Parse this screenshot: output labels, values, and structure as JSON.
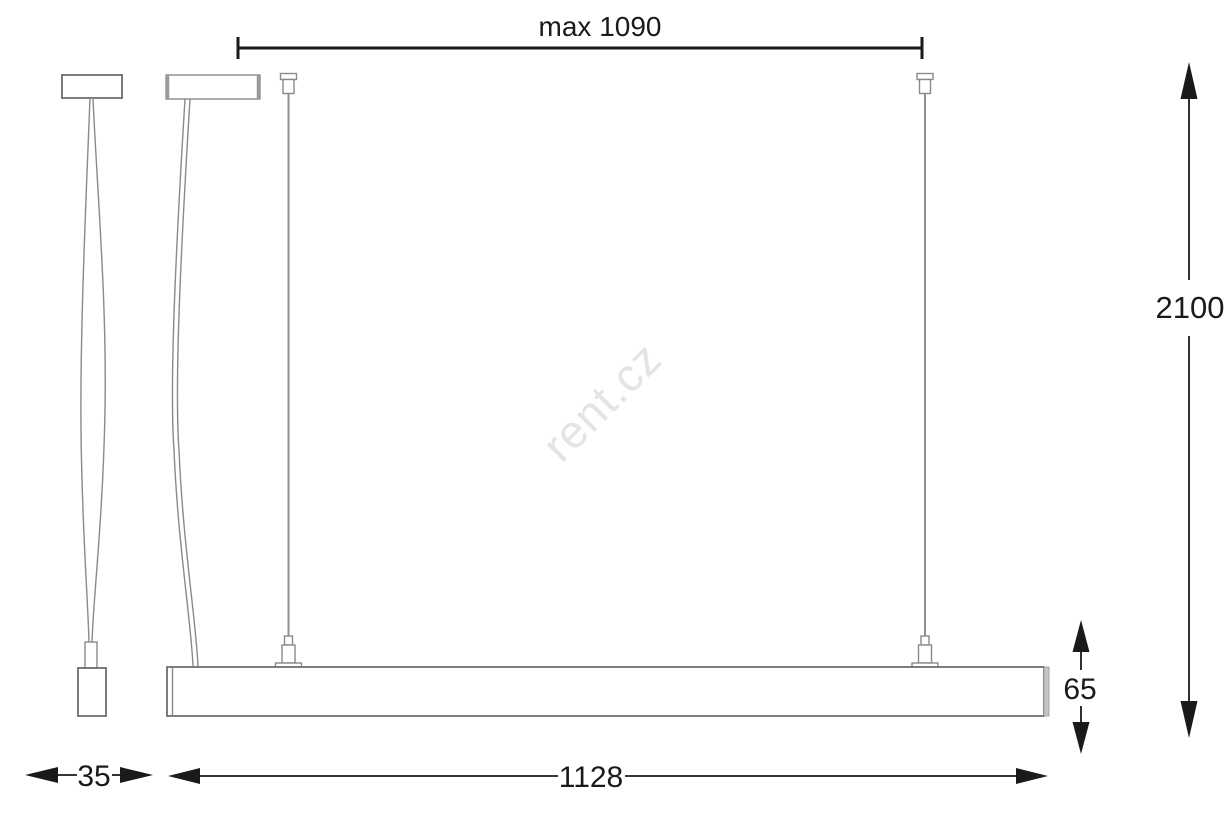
{
  "page": {
    "background": "#ffffff",
    "description": "Technical dimension drawing of a linear suspension pendant light fixture"
  },
  "colors": {
    "drawing_line": "#8a8a8a",
    "drawing_outline": "#6f6f6f",
    "dimension": "#1a1a1a",
    "end_cap": "#c4c4c4",
    "watermark": "#e4e4e4"
  },
  "watermark": {
    "text": "rent.cz"
  },
  "dimensions": {
    "max_suspension_width": "max 1090",
    "overall_drop": "2100",
    "bar_height": "65",
    "bar_length": "1128",
    "profile_width": "35"
  }
}
